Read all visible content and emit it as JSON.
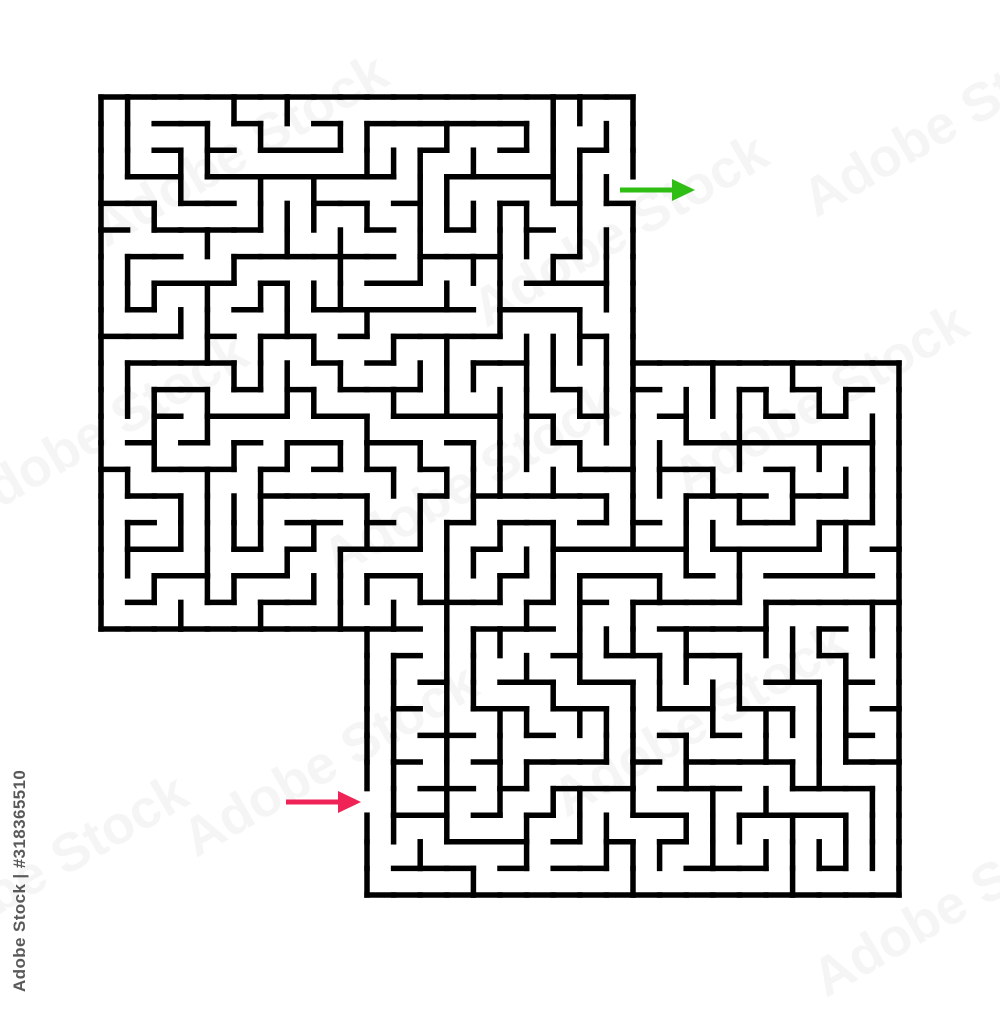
{
  "image": {
    "background": "#ffffff",
    "description": "Abstract L-shaped maze puzzle with black walls, a colored entry arrow and a colored exit arrow on a white background"
  },
  "maze": {
    "rows": 30,
    "cols": 30,
    "cell": 26.6,
    "origin_x": 101,
    "origin_y": 97,
    "wall_color": "#000000",
    "wall_width": 5.5,
    "seed": 318365510,
    "blocked_regions": [
      {
        "r0": 0,
        "r1": 9,
        "c0": 20,
        "c1": 29
      },
      {
        "r0": 20,
        "r1": 29,
        "c0": 0,
        "c1": 9
      }
    ],
    "exit_opening": {
      "row": 3,
      "col": 19,
      "side": "right"
    },
    "entrance_opening": {
      "row": 26,
      "col": 10,
      "side": "left"
    }
  },
  "arrows": {
    "exit": {
      "label": "exit-arrow",
      "color": "#2fbe14",
      "y": 190,
      "tail_x": 620,
      "head_base_x": 672,
      "tip_x": 695,
      "half_height": 11,
      "line_width": 5
    },
    "entrance": {
      "label": "entrance-arrow",
      "color": "#ef2356",
      "y": 802,
      "tail_x": 286,
      "head_base_x": 338,
      "tip_x": 361,
      "half_height": 11,
      "line_width": 5
    }
  },
  "watermark": {
    "side_text": "Adobe Stock | #318365510",
    "stock_id": "318365510",
    "diagonal_text": "Adobe Stock",
    "side_text_color": "#4c4c4c",
    "diagonal_opacity": 0.05
  }
}
